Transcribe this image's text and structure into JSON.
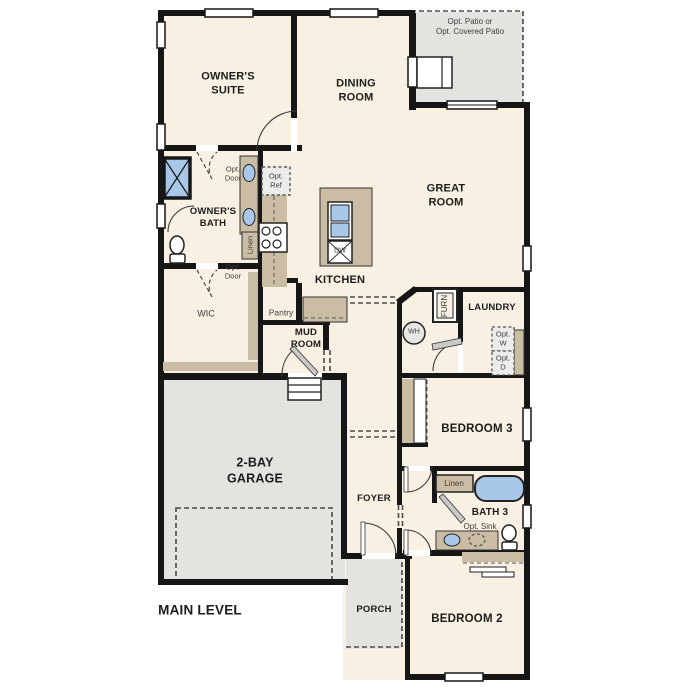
{
  "plan_title": "MAIN LEVEL",
  "colors": {
    "floor": "#f8f0e2",
    "outdoor": "#e4e3e0",
    "wall": "#161616",
    "cabinet": "#cbbda3",
    "fixture": "#a9c8e9"
  },
  "rooms": {
    "owners_suite": "OWNER'S\nSUITE",
    "dining_room": "DINING\nROOM",
    "great_room": "GREAT\nROOM",
    "owners_bath": "OWNER'S\nBATH",
    "kitchen": "KITCHEN",
    "wic": "WIC",
    "pantry": "Pantry",
    "mud_room": "MUD\nROOM",
    "laundry": "LAUNDRY",
    "garage": "2-BAY\nGARAGE",
    "bedroom3": "BEDROOM 3",
    "bath3": "BATH 3",
    "foyer": "FOYER",
    "porch": "PORCH",
    "bedroom2": "BEDROOM 2"
  },
  "annotations": {
    "opt_patio": "Opt. Patio or\nOpt. Covered Patio",
    "opt_door": "Opt.\nDoor",
    "opt_ref": "Opt.\nRef",
    "opt_w": "Opt.\nW",
    "opt_d": "Opt.\nD",
    "opt_sink": "Opt. Sink",
    "linen": "Linen",
    "furn": "FURN",
    "wh": "WH",
    "dw": "DW"
  }
}
